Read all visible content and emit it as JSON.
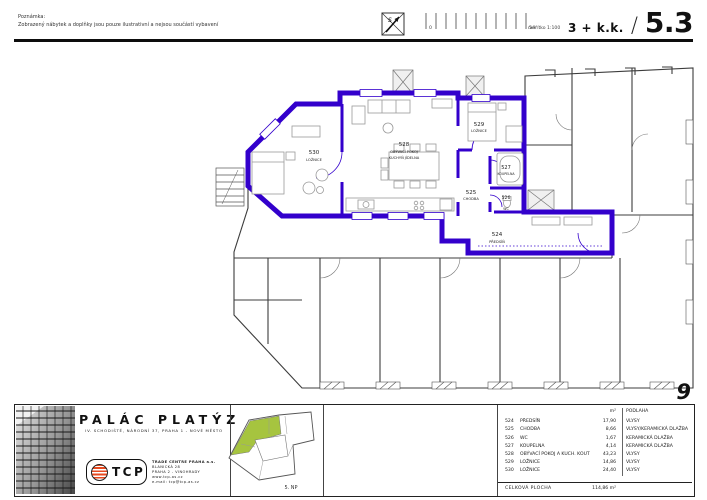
{
  "header": {
    "note_label": "Poznámka:",
    "note_text": "Zobrazený nábytek a doplňky jsou pouze ilustrativní a nejsou součástí vybavení",
    "north_letter": "S",
    "scale_zero": "0",
    "scale_five": "5m",
    "scale_caption": "měřítko 1:100",
    "layout_type": "3 + k.k.",
    "separator": "/",
    "unit_number": "5.3"
  },
  "plan": {
    "page_number": "9",
    "accent_color": "#3300CC",
    "labels": [
      {
        "id": "530",
        "line1": "LOŽNICE",
        "line2": ""
      },
      {
        "id": "528",
        "line1": "OBÝVACÍ POKOJ",
        "line2": "KUCHYŇ JÍDELNA"
      },
      {
        "id": "529",
        "line1": "LOŽNICE",
        "line2": ""
      },
      {
        "id": "527",
        "line1": "KOUPELNA",
        "line2": ""
      },
      {
        "id": "525",
        "line1": "CHODBA",
        "line2": ""
      },
      {
        "id": "526",
        "line1": "WC",
        "line2": ""
      },
      {
        "id": "524",
        "line1": "PŘEDSÍŇ",
        "line2": ""
      }
    ]
  },
  "titleblock": {
    "project_title": "PALÁC PLATÝZ",
    "project_subtitle": "IV. SCHODIŠTĚ, NÁRODNÍ 37, PRAHA 1 - NOVÉ MĚSTO",
    "logo_letters": "TCP",
    "company_name": "TRADE CENTRE PRAHA a.s.",
    "company_address1": "BLANICKÁ 28",
    "company_address2": "PRAHA 2 - VINOHRADY",
    "company_web": "www.tcp-as.cz",
    "company_email": "e-mail: tcp@tcp-as.cz",
    "keyplan_floor": "5. NP",
    "keyplan_highlight_color": "#A6C43F",
    "logo_red": "#E8491F"
  },
  "table": {
    "header_area": "m²",
    "header_floor": "PODLAHA",
    "rows": [
      {
        "id": "524",
        "name": "PŘEDSÍŇ",
        "area": "17,90",
        "floor": "VLYSY"
      },
      {
        "id": "525",
        "name": "CHODBA",
        "area": "8,66",
        "floor": "VLYSY/KERAMICKÁ DLAŽBA"
      },
      {
        "id": "526",
        "name": "WC",
        "area": "1,67",
        "floor": "KERAMICKÁ DLAŽBA"
      },
      {
        "id": "527",
        "name": "KOUPELNA",
        "area": "4,14",
        "floor": "KERAMICKÁ DLAŽBA"
      },
      {
        "id": "528",
        "name": "OBÝVACÍ POKOJ A KUCH. KOUT",
        "area": "43,23",
        "floor": "VLYSY"
      },
      {
        "id": "529",
        "name": "LOŽNICE",
        "area": "14,86",
        "floor": "VLYSY"
      },
      {
        "id": "530",
        "name": "LOŽNICE",
        "area": "24,40",
        "floor": "VLYSY"
      }
    ],
    "total_label": "CELKOVÁ PLOCHA",
    "total_value": "114,86 m²"
  }
}
